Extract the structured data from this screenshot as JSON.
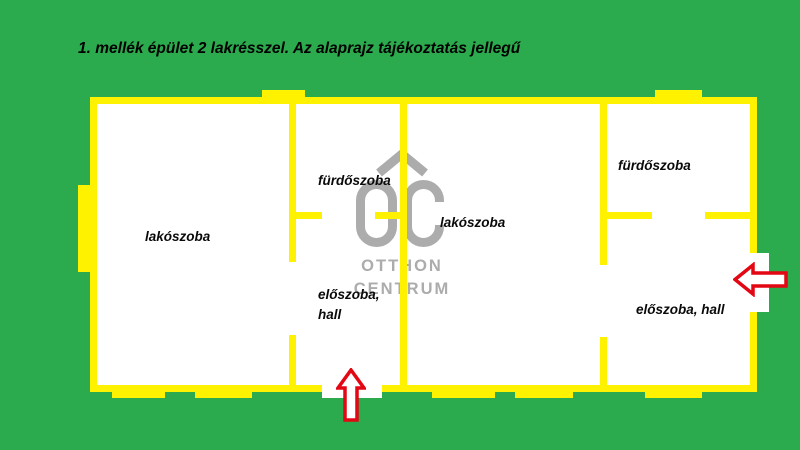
{
  "title": "1. mellék épület 2 lakrésszel. Az alaprajz tájékoztatás jellegű",
  "floorplan": {
    "rooms": {
      "left_living": "lakószoba",
      "mid_bath": "fürdőszoba",
      "mid_living": "lakószoba",
      "right_bath": "fürdőszoba",
      "mid_hall": "előszoba,\nhall",
      "right_hall": "előszoba, hall"
    }
  },
  "watermark": {
    "logo": "oc-house-logo",
    "line1": "OTTHON",
    "line2": "CENTRUM"
  },
  "icons": {
    "entrance_bottom": "arrow-up-icon",
    "entrance_right": "arrow-left-icon"
  },
  "colors": {
    "background_green": "#2BAB4D",
    "wall_yellow": "#FFF200",
    "arrow_red": "#E30613",
    "watermark_gray": "#ACACAC",
    "label_black": "#0A0A0A"
  }
}
